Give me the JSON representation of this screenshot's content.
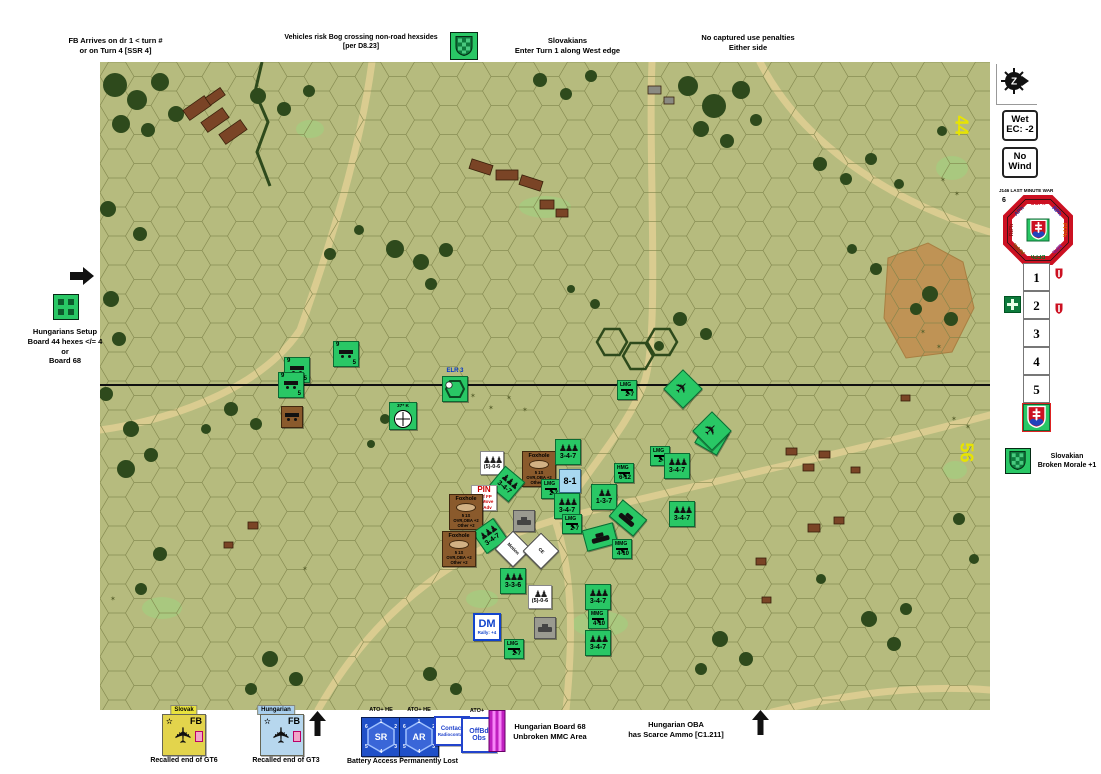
{
  "annotations": {
    "fb_arrives": [
      "FB Arrives on dr 1 < turn #",
      "or on Turn 4 [SSR 4]"
    ],
    "bog": [
      "Vehicles risk Bog crossing non-road hexsides",
      "[per D8.23]"
    ],
    "slovak_entry": [
      "Slovakians",
      "Enter Turn 1 along West edge"
    ],
    "captured": [
      "No captured use penalties",
      "Either side"
    ],
    "setup": [
      "Hungarians Setup",
      "Board 44 hexes </= 4",
      "or",
      "Board 68"
    ],
    "broken_morale": [
      "Slovakian",
      "Broken Morale +1"
    ],
    "board68": [
      "Hungarian Board 68",
      "Unbroken MMC Area"
    ],
    "oba": [
      "Hungarian OBA",
      "has Scarce Ammo [C1.211]"
    ],
    "battery_lost": "Battery Access Permanently Lost",
    "recall_slovak": "Recalled end of GT6",
    "recall_hungarian": "Recalled end of GT3"
  },
  "panel": {
    "wet": [
      "Wet",
      "EC: -2"
    ],
    "wind": [
      "No",
      "Wind"
    ],
    "scenario_title": "J146 LAST MINUTE WAR",
    "dial_number": "6",
    "phases": [
      {
        "label": "CCPh",
        "color": "#cc1122"
      },
      {
        "label": "RPh",
        "color": "#1133cc"
      },
      {
        "label": "PFPh",
        "color": "#dd6600"
      },
      {
        "label": "MPh",
        "color": "#7722aa"
      },
      {
        "label": "DFPh",
        "color": "#007722"
      },
      {
        "label": "AFPh",
        "color": "#775500"
      },
      {
        "label": "RtPh",
        "color": "#881111"
      },
      {
        "label": "APh",
        "color": "#223388"
      }
    ],
    "turn_cells": [
      "1",
      "2",
      "3",
      "4",
      "5"
    ]
  },
  "map": {
    "board_number_top": "44",
    "board_number_bottom": "56",
    "counters": [
      {
        "type": "wagon",
        "x": 346,
        "y": 354,
        "a": "9",
        "b": "5"
      },
      {
        "type": "wagon",
        "x": 297,
        "y": 370,
        "a": "9",
        "b": "5"
      },
      {
        "type": "wagon",
        "x": 291,
        "y": 385,
        "a": "9",
        "b": "5"
      },
      {
        "type": "brown",
        "x": 292,
        "y": 417
      },
      {
        "type": "gun",
        "x": 403,
        "y": 416,
        "a": "37* K"
      },
      {
        "type": "elr",
        "x": 455,
        "y": 389,
        "a": "ELR 3"
      },
      {
        "type": "crewW",
        "x": 492,
        "y": 463,
        "b": "(5)-0-6",
        "figs": 3
      },
      {
        "type": "foxhole",
        "x": 539,
        "y": 469,
        "r": [
          "Foxhole",
          "5  1S",
          "OVR,OBA +2",
          "Other +2"
        ]
      },
      {
        "type": "sw",
        "x": 551,
        "y": 489,
        "a": "LMG",
        "b": "2-7"
      },
      {
        "type": "squad",
        "x": 507,
        "y": 484,
        "rot": 40,
        "b": "3-4-7"
      },
      {
        "type": "pin",
        "x": 484,
        "y": 498,
        "p": [
          "PIN",
          "Half FP",
          "No Move",
          "No Adv"
        ]
      },
      {
        "type": "foxhole",
        "x": 466,
        "y": 512,
        "r": [
          "Foxhole",
          "5  1S",
          "OVR,OBA +2",
          "Other +2"
        ]
      },
      {
        "type": "gray",
        "x": 524,
        "y": 521
      },
      {
        "type": "squad",
        "x": 490,
        "y": 536,
        "rot": -35,
        "b": "3-4-7"
      },
      {
        "type": "foxhole",
        "x": 459,
        "y": 549,
        "r": [
          "Foxhole",
          "5  1S",
          "OVR,OBA +2",
          "Other +2"
        ]
      },
      {
        "type": "whiteR",
        "x": 513,
        "y": 549,
        "rot": 45,
        "b": "Motion"
      },
      {
        "type": "whiteR",
        "x": 541,
        "y": 551,
        "rot": 45,
        "b": "CE"
      },
      {
        "type": "squad",
        "x": 568,
        "y": 452,
        "b": "3-4-7"
      },
      {
        "type": "sw",
        "x": 660,
        "y": 456,
        "a": "LMG",
        "b": "2-7"
      },
      {
        "type": "squad",
        "x": 677,
        "y": 466,
        "b": "3-4-7"
      },
      {
        "type": "sw",
        "x": 624,
        "y": 473,
        "a": "HMG",
        "b": "6-12"
      },
      {
        "type": "leader",
        "x": 570,
        "y": 481,
        "b": "8-1"
      },
      {
        "type": "squad",
        "x": 604,
        "y": 497,
        "b": "1-3-7",
        "figs": 2
      },
      {
        "type": "squad",
        "x": 567,
        "y": 506,
        "b": "3-4-7"
      },
      {
        "type": "tankR",
        "x": 628,
        "y": 518,
        "rot": 40
      },
      {
        "type": "squad",
        "x": 682,
        "y": 514,
        "b": "3-4-7"
      },
      {
        "type": "sw",
        "x": 572,
        "y": 524,
        "a": "LMG",
        "b": "2-7"
      },
      {
        "type": "tankR",
        "x": 600,
        "y": 537,
        "rot": -15
      },
      {
        "type": "sw",
        "x": 622,
        "y": 549,
        "a": "MMG",
        "b": "4-10"
      },
      {
        "type": "squad",
        "x": 712,
        "y": 438,
        "rot": 30,
        "b": "3-4-7"
      },
      {
        "type": "planeR",
        "x": 683,
        "y": 389,
        "rot": 45
      },
      {
        "type": "planeR",
        "x": 712,
        "y": 431,
        "rot": 45
      },
      {
        "type": "sw",
        "x": 627,
        "y": 390,
        "a": "LMG",
        "b": "2-7"
      },
      {
        "type": "squad",
        "x": 513,
        "y": 581,
        "b": "3-3-6"
      },
      {
        "type": "crewW",
        "x": 540,
        "y": 597,
        "b": "(5)-0-6",
        "figs": 2
      },
      {
        "type": "dm",
        "x": 487,
        "y": 627,
        "a": "DM",
        "b": "Rally: +4"
      },
      {
        "type": "sw",
        "x": 514,
        "y": 649,
        "a": "LMG",
        "b": "2-7"
      },
      {
        "type": "gray",
        "x": 545,
        "y": 628
      },
      {
        "type": "squad",
        "x": 598,
        "y": 597,
        "b": "3-4-7"
      },
      {
        "type": "sw",
        "x": 598,
        "y": 619,
        "a": "MMG",
        "b": "4-10"
      },
      {
        "type": "squad",
        "x": 598,
        "y": 643,
        "b": "3-4-7"
      }
    ]
  },
  "bottom": {
    "slovak_tab": "Slovak",
    "hungarian_tab": "Hungarian",
    "fb_label": "FB",
    "ato_he": "ATO+ HE",
    "ato": "ATO+",
    "sr_label": "SR",
    "ar_label": "AR",
    "hex_numbers": [
      "1",
      "2",
      "3",
      "4",
      "5",
      "6"
    ],
    "contact": [
      "Contact",
      "Radiocontact"
    ],
    "offbd": [
      "OffBd",
      "Obs"
    ]
  }
}
